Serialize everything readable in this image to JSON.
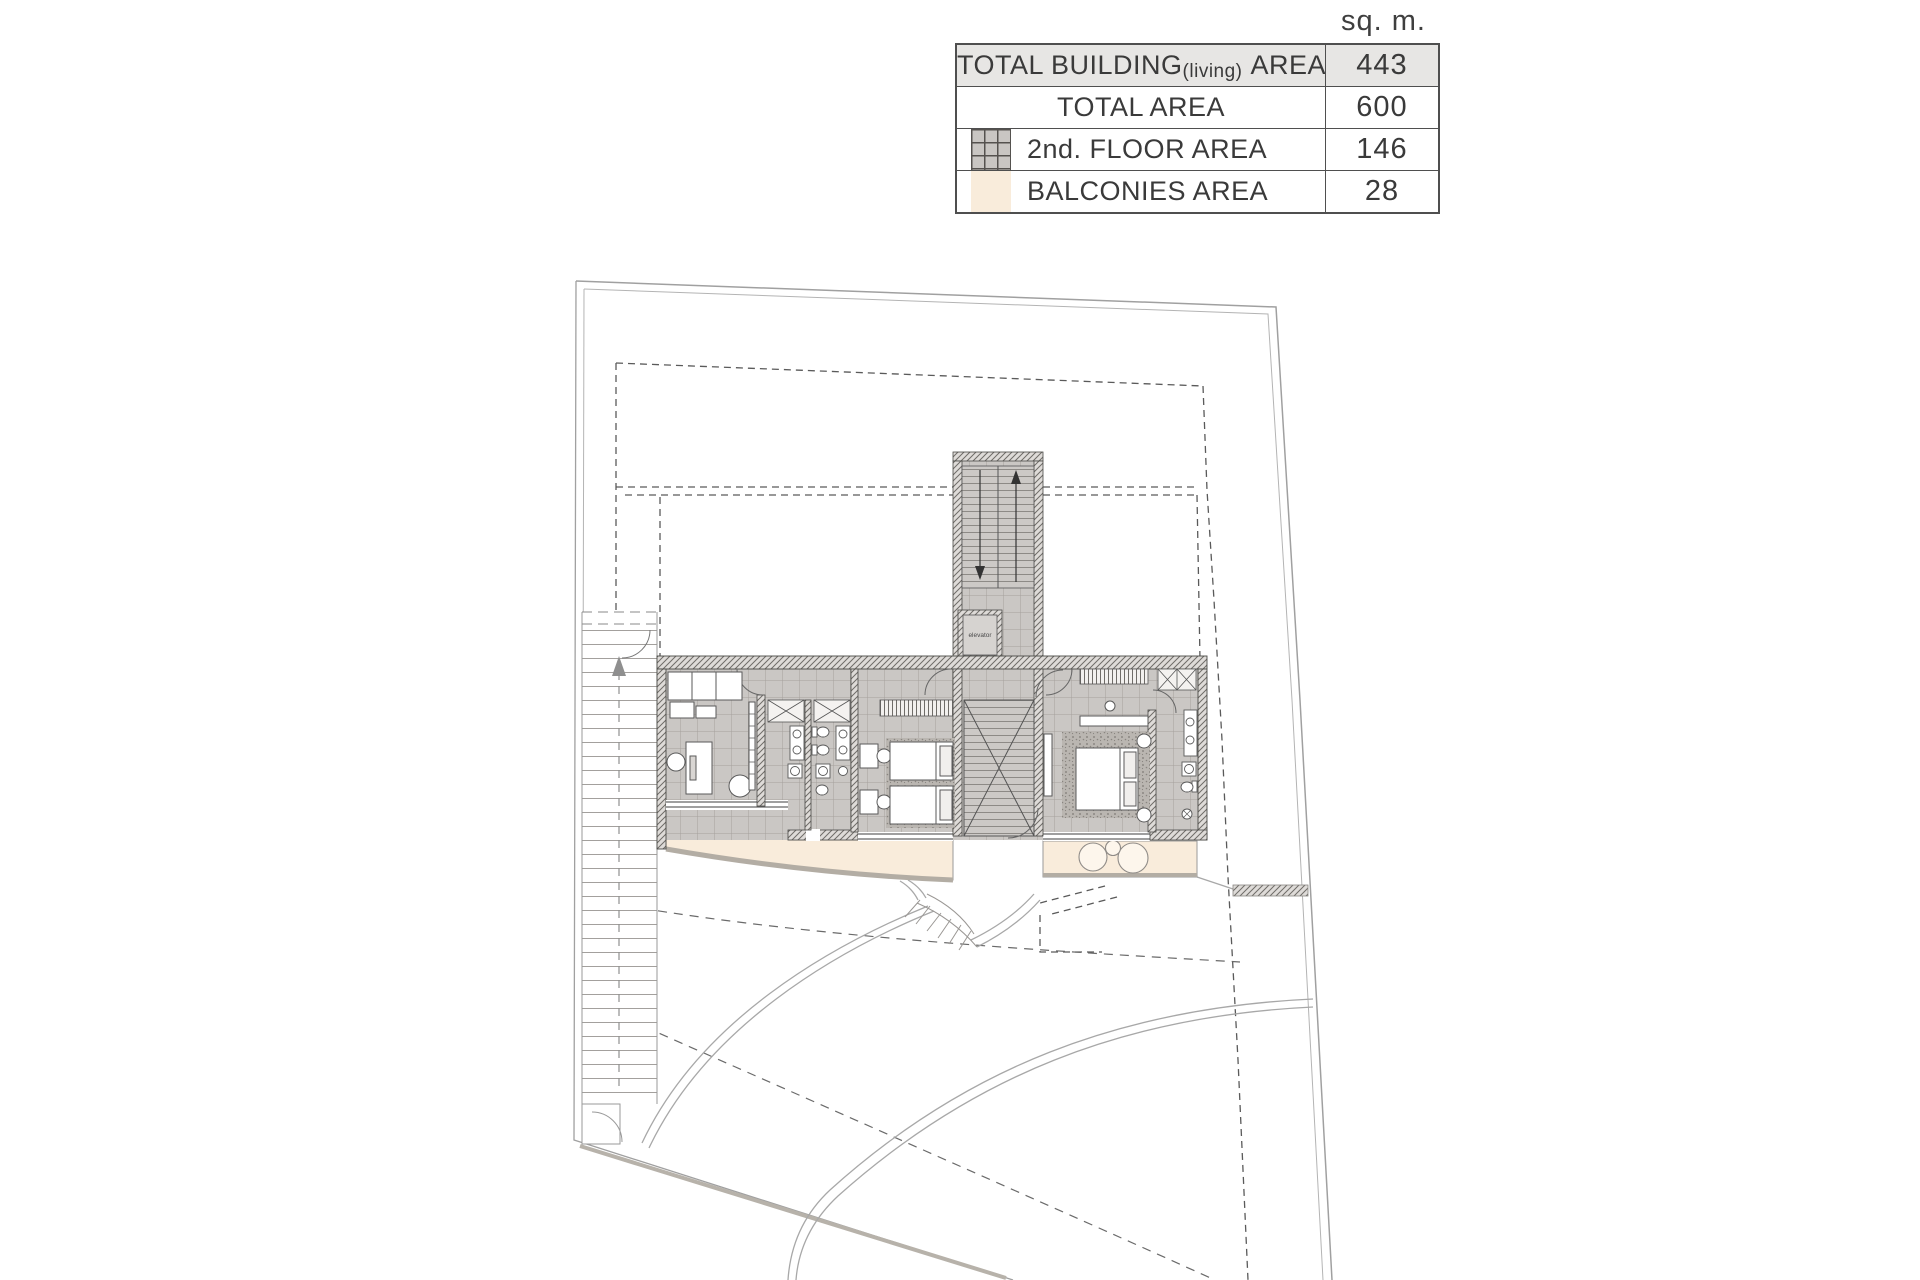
{
  "unit_label": "sq. m.",
  "table": {
    "rows": [
      {
        "label_main": "TOTAL BUILDING",
        "label_small": "(living)",
        "label_suffix": "AREA",
        "value": "443"
      },
      {
        "label_main": "TOTAL AREA",
        "value": "600"
      },
      {
        "label_main": "2nd. FLOOR AREA",
        "value": "146"
      },
      {
        "label_main": "BALCONIES AREA",
        "value": "28"
      }
    ]
  },
  "plan": {
    "elevator_label": "elevator"
  },
  "colors": {
    "floor_tile": "#cac7c4",
    "tile_line": "#a5a19d",
    "wall_fill": "#dedbd8",
    "wall_hatch_line": "#6f6c68",
    "wall_outline": "#4a4a46",
    "balcony": "#f9ecdb",
    "carpet": "#bab6b1",
    "boundary_line": "#a0a0a0",
    "setback_dash": "#5a5a5a",
    "driveway_line": "#a8a8a8",
    "retaining_wall": "#b7b2aa",
    "table_border": "#4f4f4f",
    "row_highlight": "#e7e6e4",
    "text": "#3a3a3a"
  }
}
